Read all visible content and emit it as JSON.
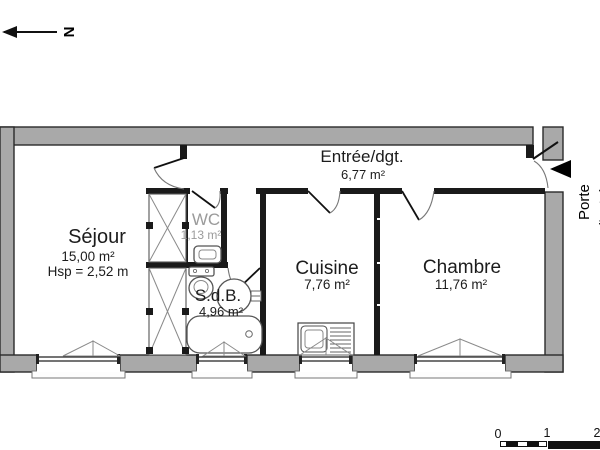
{
  "north": {
    "label": "N"
  },
  "rooms": {
    "sejour": {
      "name": "Séjour",
      "area": "15,00 m²",
      "ceiling": "Hsp = 2,52 m"
    },
    "wc": {
      "name": "WC",
      "area": "1,13 m²"
    },
    "sdb": {
      "name": "S.d.B.",
      "area": "4,96 m²"
    },
    "cuisine": {
      "name": "Cuisine",
      "area": "7,76 m²"
    },
    "chambre": {
      "name": "Chambre",
      "area": "11,76 m²"
    },
    "entree": {
      "name": "Entrée/dgt.",
      "area": "6,77 m²"
    }
  },
  "annotations": {
    "entrance_door_label": "Porte",
    "entrance_door_label2": "d'entrée"
  },
  "scale_bar": {
    "tick0": "0",
    "tick1": "1",
    "tick2": "2"
  },
  "colors": {
    "wall_gray": "#a9a9a9",
    "wall_dark": "#1a1a1a",
    "fixture_line": "#555555",
    "muted_text": "#9b9b9b"
  }
}
